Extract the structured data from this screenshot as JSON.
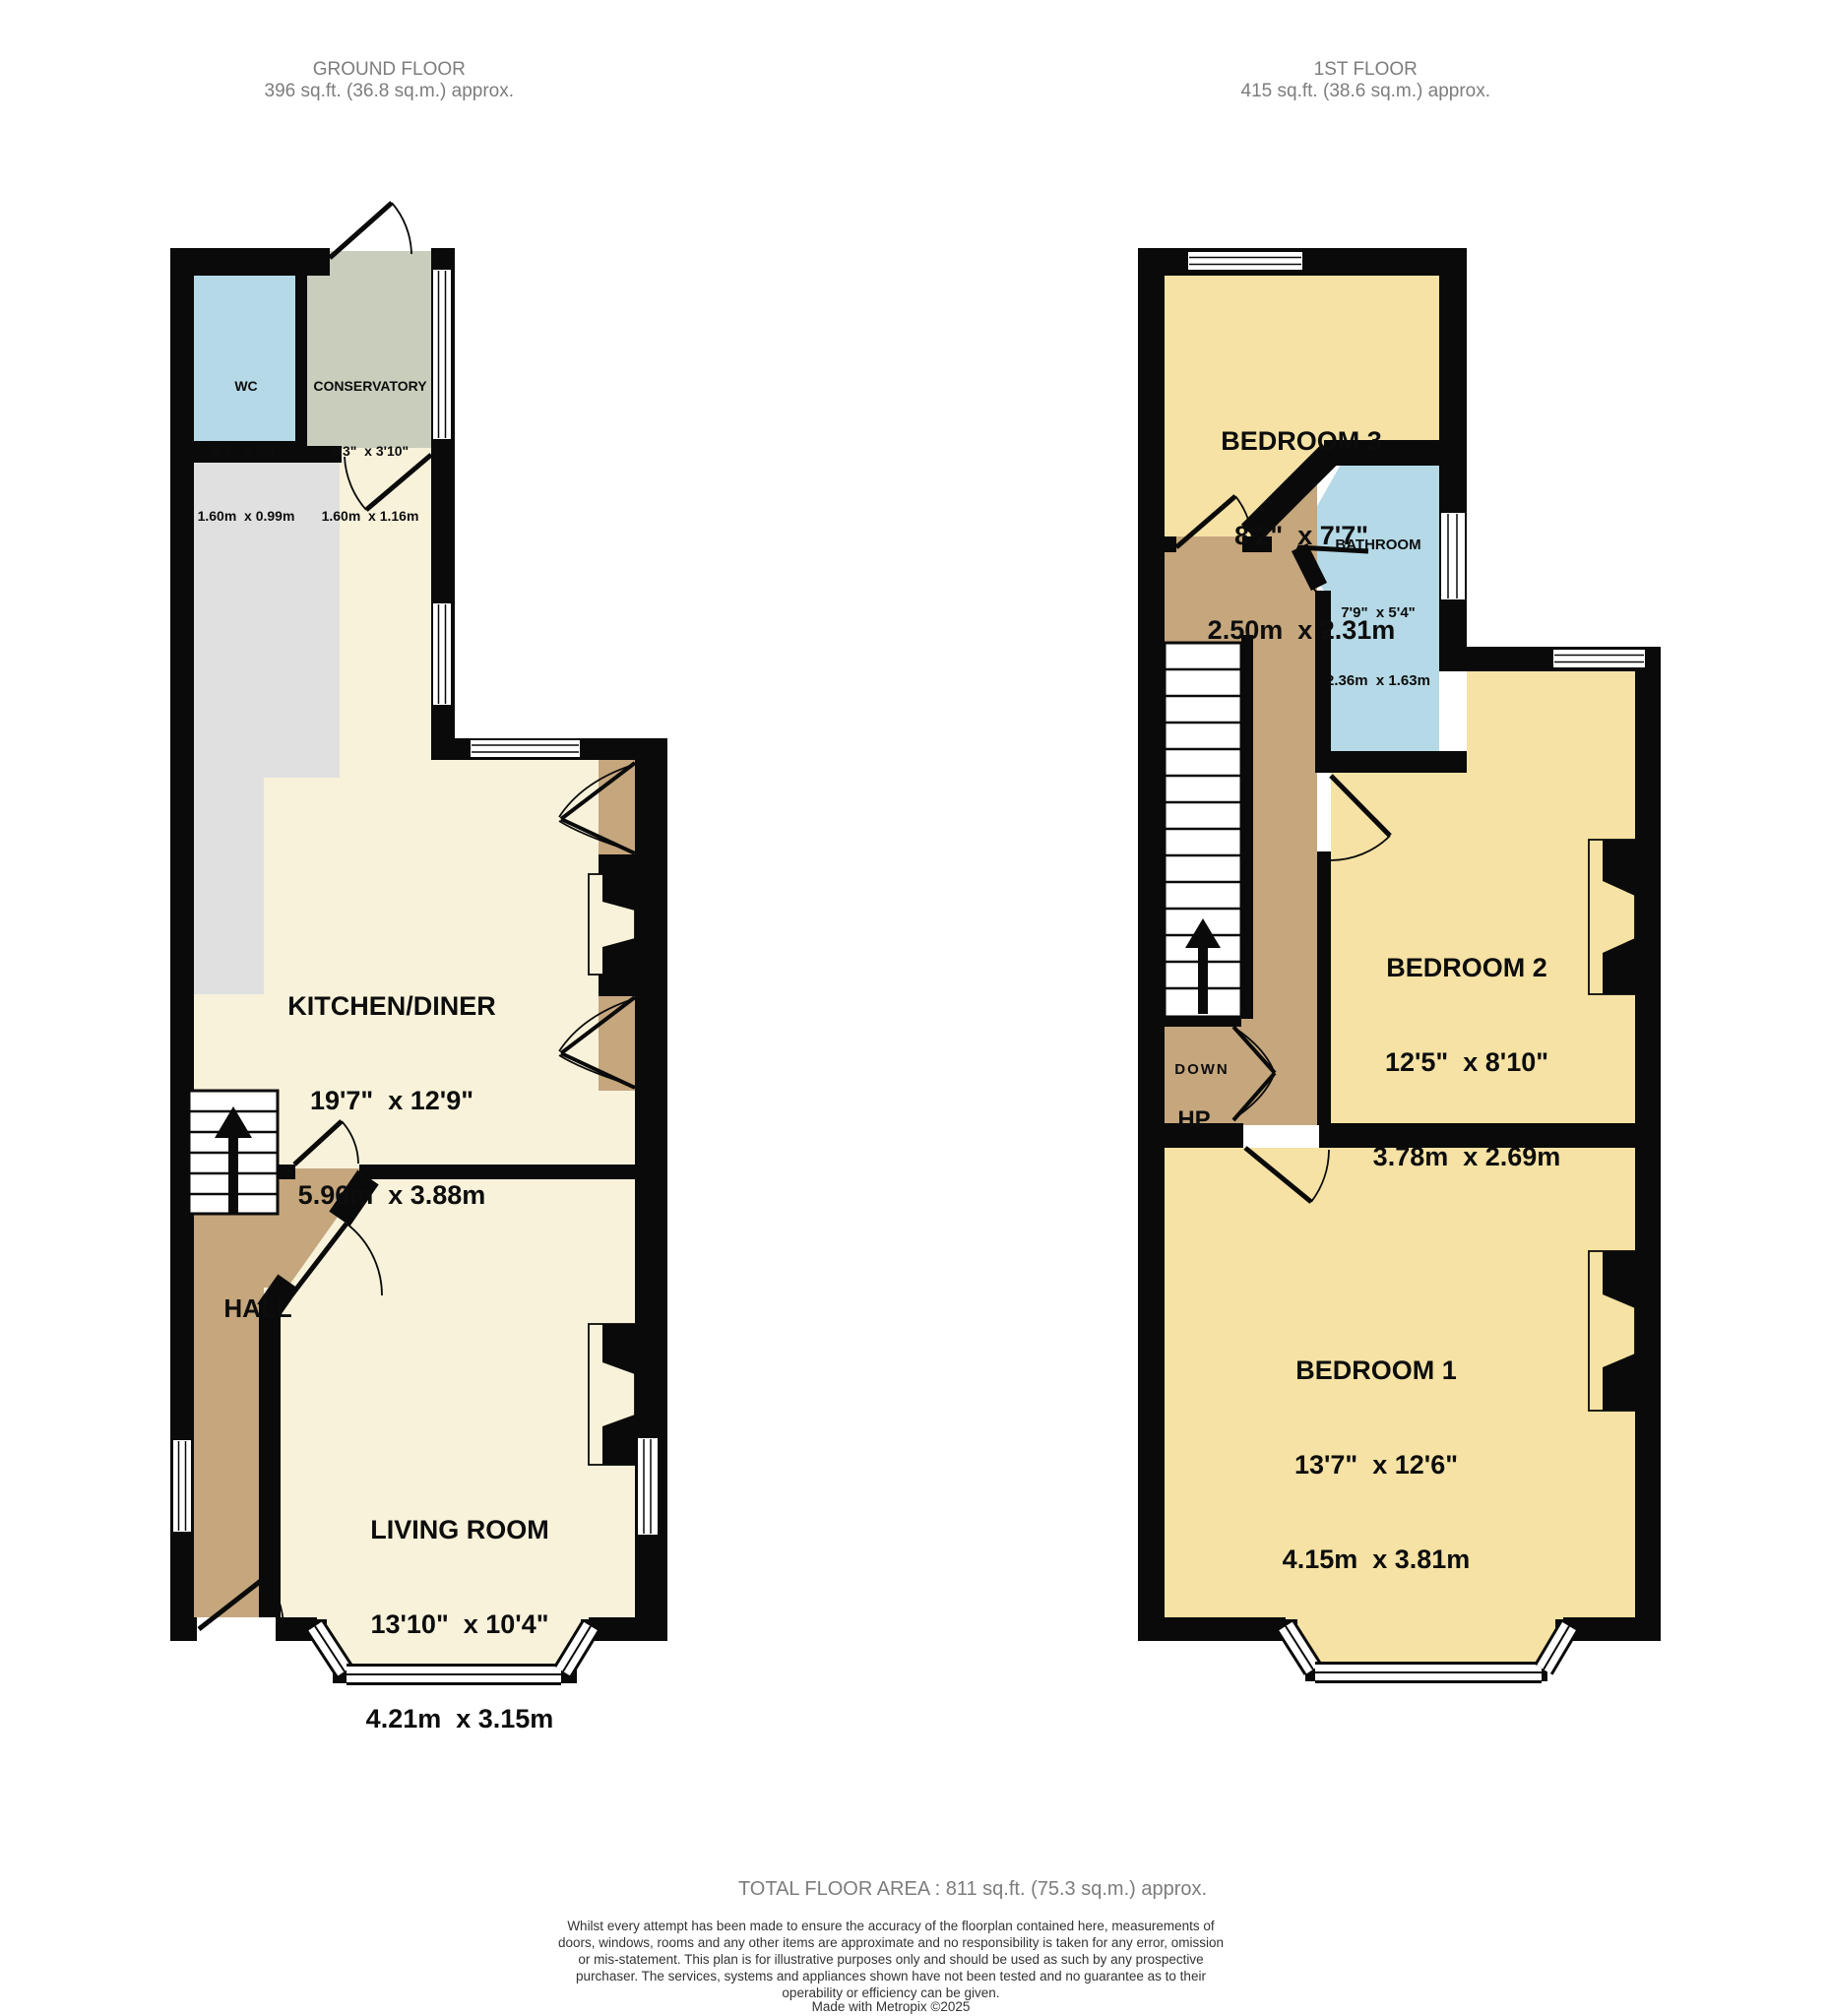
{
  "ground_floor": {
    "title": "GROUND FLOOR",
    "area": "396 sq.ft. (36.8 sq.m.) approx.",
    "rooms": {
      "wc": {
        "name": "WC",
        "imperial": "5'3\"  x 3'3\"",
        "metric": "1.60m  x 0.99m"
      },
      "conservatory": {
        "name": "CONSERVATORY",
        "imperial": "5'3\"  x 3'10\"",
        "metric": "1.60m  x 1.16m"
      },
      "kitchen_diner": {
        "name": "KITCHEN/DINER",
        "imperial": "19'7\"  x 12'9\"",
        "metric": "5.96m  x 3.88m"
      },
      "hall": {
        "name": "HALL"
      },
      "living_room": {
        "name": "LIVING ROOM",
        "imperial": "13'10\"  x 10'4\"",
        "metric": "4.21m  x 3.15m"
      }
    }
  },
  "first_floor": {
    "title": "1ST FLOOR",
    "area": "415 sq.ft. (38.6 sq.m.) approx.",
    "rooms": {
      "bedroom3": {
        "name": "BEDROOM 3",
        "imperial": "8'2\"  x 7'7\"",
        "metric": "2.50m  x 2.31m"
      },
      "bathroom": {
        "name": "BATHROOM",
        "imperial": "7'9\"  x 5'4\"",
        "metric": "2.36m  x 1.63m"
      },
      "bedroom2": {
        "name": "BEDROOM 2",
        "imperial": "12'5\"  x 8'10\"",
        "metric": "3.78m  x 2.69m"
      },
      "bedroom1": {
        "name": "BEDROOM 1",
        "imperial": "13'7\"  x 12'6\"",
        "metric": "4.15m  x 3.81m"
      }
    },
    "labels": {
      "down": "DOWN",
      "hp": "HP"
    }
  },
  "footer": {
    "total": "TOTAL FLOOR AREA : 811 sq.ft. (75.3 sq.m.) approx.",
    "disclaimer": "Whilst every attempt has been made to ensure the accuracy of the floorplan contained here, measurements of doors, windows, rooms and any other items are approximate and no responsibility is taken for any error, omission or mis-statement. This plan is for illustrative purposes only and should be used as such by any prospective purchaser. The services, systems and appliances shown have not been tested and no guarantee as to their operability or efficiency can be given.",
    "credit": "Made with Metropix ©2025"
  },
  "colors": {
    "wall": "#0a0a0a",
    "cream": "#f8f2da",
    "yellow": "#f5e2a4",
    "blue": "#b5d9e6",
    "sage": "#c8cdbc",
    "tan": "#c5a67d",
    "gray": "#e0e0e0",
    "window": "#ffffff",
    "header_text": "#7d7d7d",
    "disclaimer_text": "#333333"
  }
}
